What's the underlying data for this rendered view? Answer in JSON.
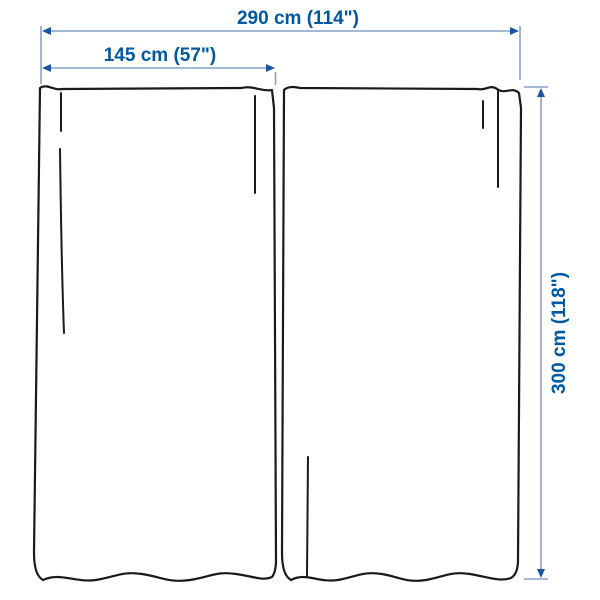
{
  "diagram": {
    "subject": "two curtain panels dimension diagram",
    "labels": {
      "total_width": "290 cm (114\")",
      "panel_width": "145 cm (57\")",
      "height": "300 cm (118\")"
    },
    "colors": {
      "label_text": "#0058a3",
      "dimension_line": "#87a3c5",
      "arrowhead": "#1d55a3",
      "curtain_outline": "#1a1a1a",
      "background": "#ffffff"
    }
  }
}
